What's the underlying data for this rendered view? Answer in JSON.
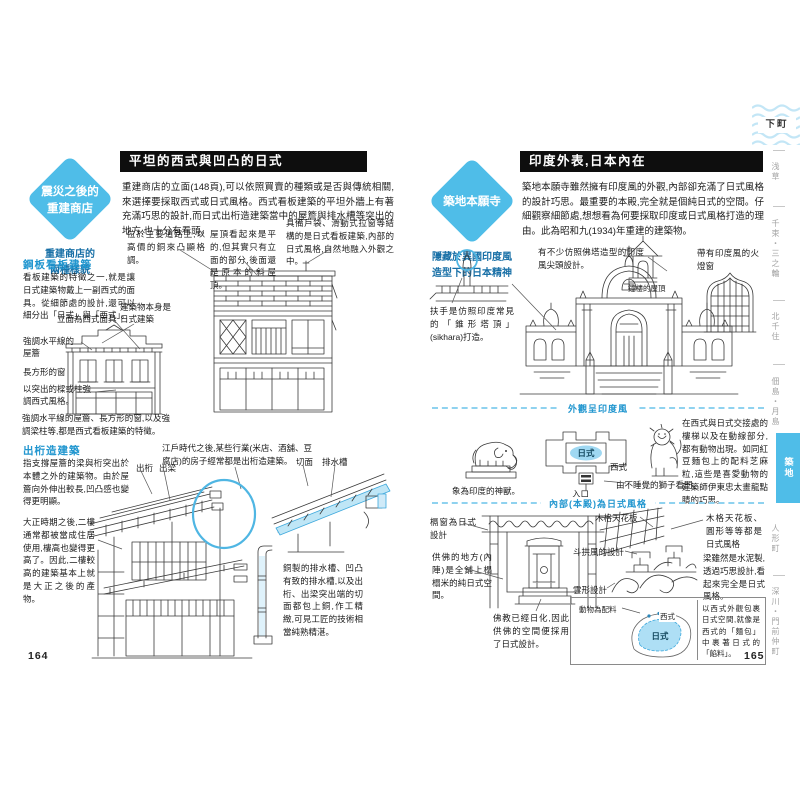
{
  "left": {
    "page_number": "164",
    "badge_line1": "震災之後的",
    "badge_line2": "重建商店",
    "badge_subtitle": "重建商店的兩種樣貌",
    "header": "平坦的西式與凹凸的日式",
    "intro": "重建商店的立面(148頁),可以依照買賣的種類或是否與傳統相關,來選擇要採取西式或日式風格。西式看板建築的平坦外牆上有著充滿巧思的設計,而日式出桁造建築當中的屋簷與排水槽等突出的地方,也十分有看頭。",
    "ann_road": "位於主要道路上,以高價的銅來凸顯格調。",
    "ann_flat_roof": "屋頂看起來是平的,但其實只有立面的部分,後面還是原本的斜屋頂。",
    "ann_japanese_inside": "具備戶袋、滑動式拉窗等結構的是日式看板建築,內部的日式風格,自然地融入外觀之中。",
    "sec1_title": "鋼板看板建築",
    "sec1_body": "看板建築的特徵之一,就是讓日式建築物戴上一副西式的面具。從細節處的設計,還可以細分出「日式」與「西式」。",
    "label_facade": "立面為西式面具",
    "label_building": "建築物本身是日式建築",
    "label_eaves": "強調水平線的屋簷",
    "label_window": "長方形的窗",
    "label_pillar": "以突出的樑或柱強調西式風格。",
    "caption_west": "強調水平線的屋簷、長方形的窗,以及強調梁柱等,都是西式看板建築的特徵。",
    "sec2_title": "出桁造建築",
    "sec2_body1": "指支撐屋簷的梁與桁突出於本體之外的建築物。由於屋簷向外伸出較長,凹凸感也變得更明顯。",
    "sec2_body2": "大正時期之後,二樓通常都被當成住居使用,樓高也變得更高了。因此,二樓較高的建築基本上就是大正之後的產物。",
    "ann_edo": "江戶時代之後,某些行業(米店、酒舖、豆腐店)的房子經常都是出桁造建築。",
    "label_degeta": "出桁",
    "label_debari": "出梁",
    "label_cut": "切面",
    "label_gutter": "排水槽",
    "ann_copper": "銅製的排水槽、凹凸有致的排水槽,以及出桁、出梁突出端的切面都包上銅,作工精緻,可見工匠的技術相當純熟精湛。"
  },
  "right": {
    "page_number": "165",
    "badge": "築地本願寺",
    "badge_subtitle": "隱藏於異國印度風造型下的日本精神",
    "header": "印度外表,日本內在",
    "intro": "築地本願寺雖然擁有印度風的外觀,內部卻充滿了日式風格的設計巧思。最重要的本殿,完全就是個純日式的空間。仔細觀察細節處,想想看為何要採取印度或日式風格打造的理由。此為昭和九(1934)年重建的建築物。",
    "ann_stupa": "有不少仿照佛塔造型的印度風尖頭設計。",
    "ann_katomado": "帶有印度風的火燈窗",
    "ann_bell": "鐘樓的屋頂",
    "ann_sikhara": "扶手是仿照印度常見的「錐形塔頂」(sikhara)打造。",
    "divider_outside": "外觀呈印度風",
    "ann_elephant": "象為印度的神獸。",
    "plan_japanese": "日式",
    "plan_western": "西式",
    "plan_entrance": "入口",
    "ann_lion": "由不睡覺的獅子看門。",
    "body_animals": "在西式與日式交接處的樓梯以及在動線部分,都有動物出現。如同紅豆麵包上的配料芝麻粒,這些是喜愛動物的建築師伊東忠太畫龍點睛的巧思。",
    "divider_inside": "內部(本殿)為日式風格",
    "ann_ranma": "槅窗為日式設計",
    "ann_naijin": "供佛的地方(內陣)是全鋪上榻榻米的純日式空間。",
    "ann_buddhism": "佛教已經日化,因此供佛的空間便採用了日式設計。",
    "label_ceiling": "木格天花板",
    "text_ceiling": "木格天花板、圓形等等都是日式風格",
    "label_bracket": "斗拱風的設計",
    "text_beam": "梁雖然是水泥製,透過巧思設計,看起來完全是日式風格。",
    "label_cloud": "雲形設計",
    "label_topping": "動物為配料",
    "diagram_japanese": "日式",
    "diagram_western": "西式",
    "text_bread": "以西式外觀包裹日式空間,就像是西式的「麵包」中裹著日式的「餡料」。"
  },
  "sidebar": {
    "chapter": "下町",
    "items": [
      {
        "label": "浅草"
      },
      {
        "label": "千束・三之輪"
      },
      {
        "label": "北千住"
      },
      {
        "label": "佃島・月島"
      },
      {
        "label": "築地",
        "active": true
      },
      {
        "label": "人形町"
      },
      {
        "label": "深川・門前仲町"
      }
    ]
  },
  "colors": {
    "accent": "#4fbde8",
    "blue_text": "#2196cf",
    "light_blue_fill": "#bfe6f6",
    "ink": "#3a3a3a"
  }
}
